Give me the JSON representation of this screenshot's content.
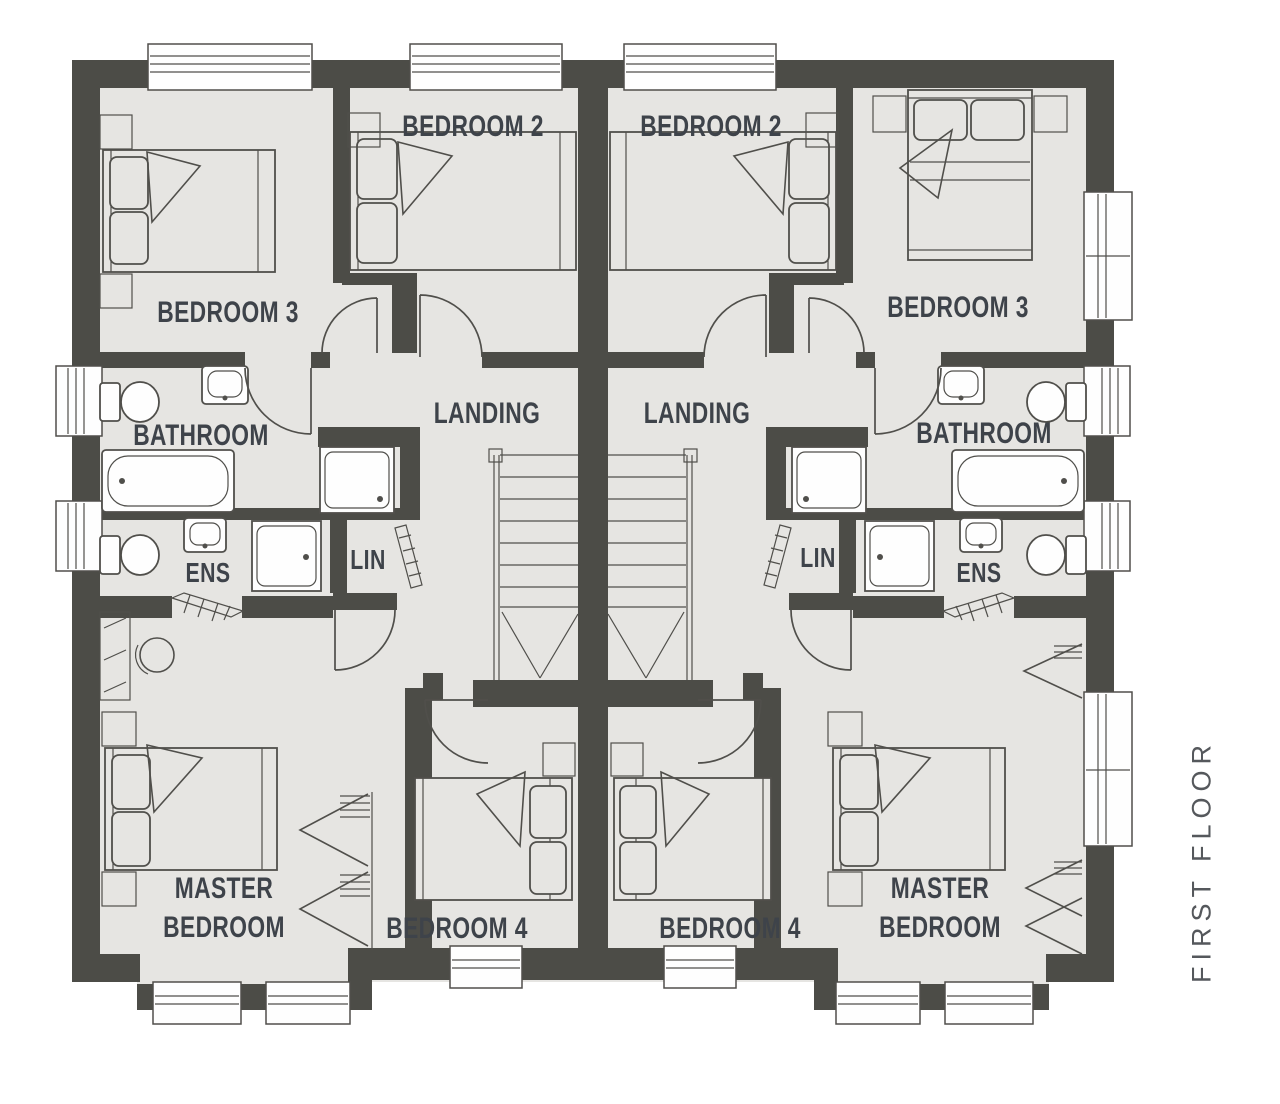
{
  "floor_label": "FIRST FLOOR",
  "houses": {
    "left": {
      "bedroom2": "BEDROOM 2",
      "bedroom3": "BEDROOM 3",
      "bedroom4": "BEDROOM 4",
      "bathroom": "BATHROOM",
      "ens": "ENS",
      "lin": "LIN",
      "landing": "LANDING",
      "master_line1": "MASTER",
      "master_line2": "BEDROOM"
    },
    "right": {
      "bedroom2": "BEDROOM 2",
      "bedroom3": "BEDROOM 3",
      "bedroom4": "BEDROOM 4",
      "bathroom": "BATHROOM",
      "ens": "ENS",
      "lin": "LIN",
      "landing": "LANDING",
      "master_line1": "MASTER",
      "master_line2": "BEDROOM"
    }
  },
  "colors": {
    "wall": "#4c4c47",
    "floor": "#e6e5e2",
    "outline": "#504f4b",
    "text": "#3e434a",
    "annotation": "#55585c",
    "window": "#fefefe",
    "background": "#ffffff"
  }
}
